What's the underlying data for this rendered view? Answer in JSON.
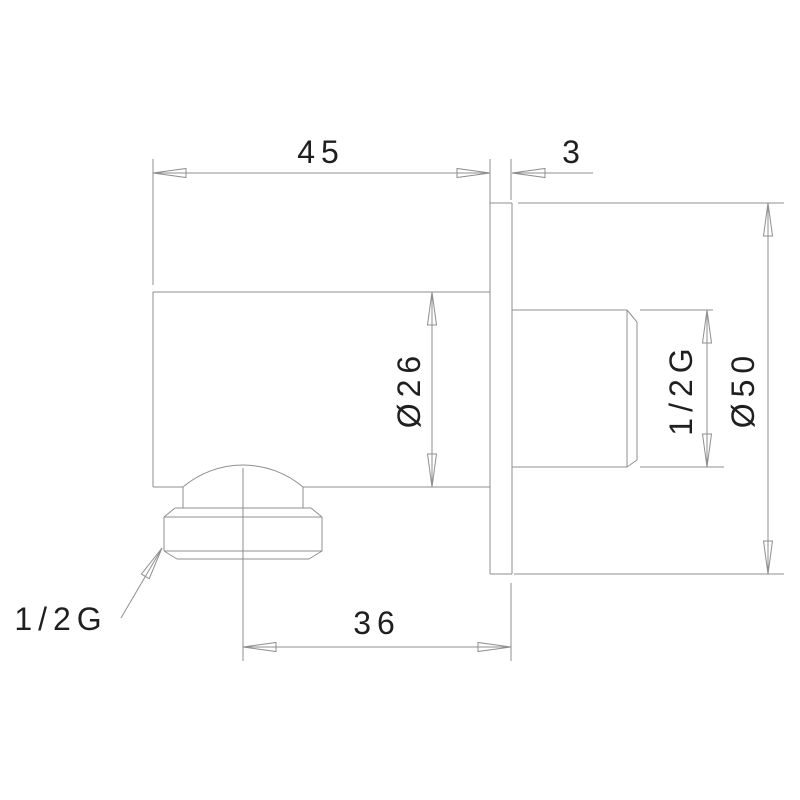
{
  "drawing": {
    "colors": {
      "line": "#8f8f8f",
      "text": "#1f1f1f",
      "background": "#ffffff"
    },
    "dims": {
      "body_depth": "45",
      "plate_thickness": "3",
      "body_diameter": "Ø26",
      "wall_thread": "1/2G",
      "plate_diameter": "Ø50",
      "hose_thread": "1/2G",
      "outlet_offset": "36"
    }
  }
}
